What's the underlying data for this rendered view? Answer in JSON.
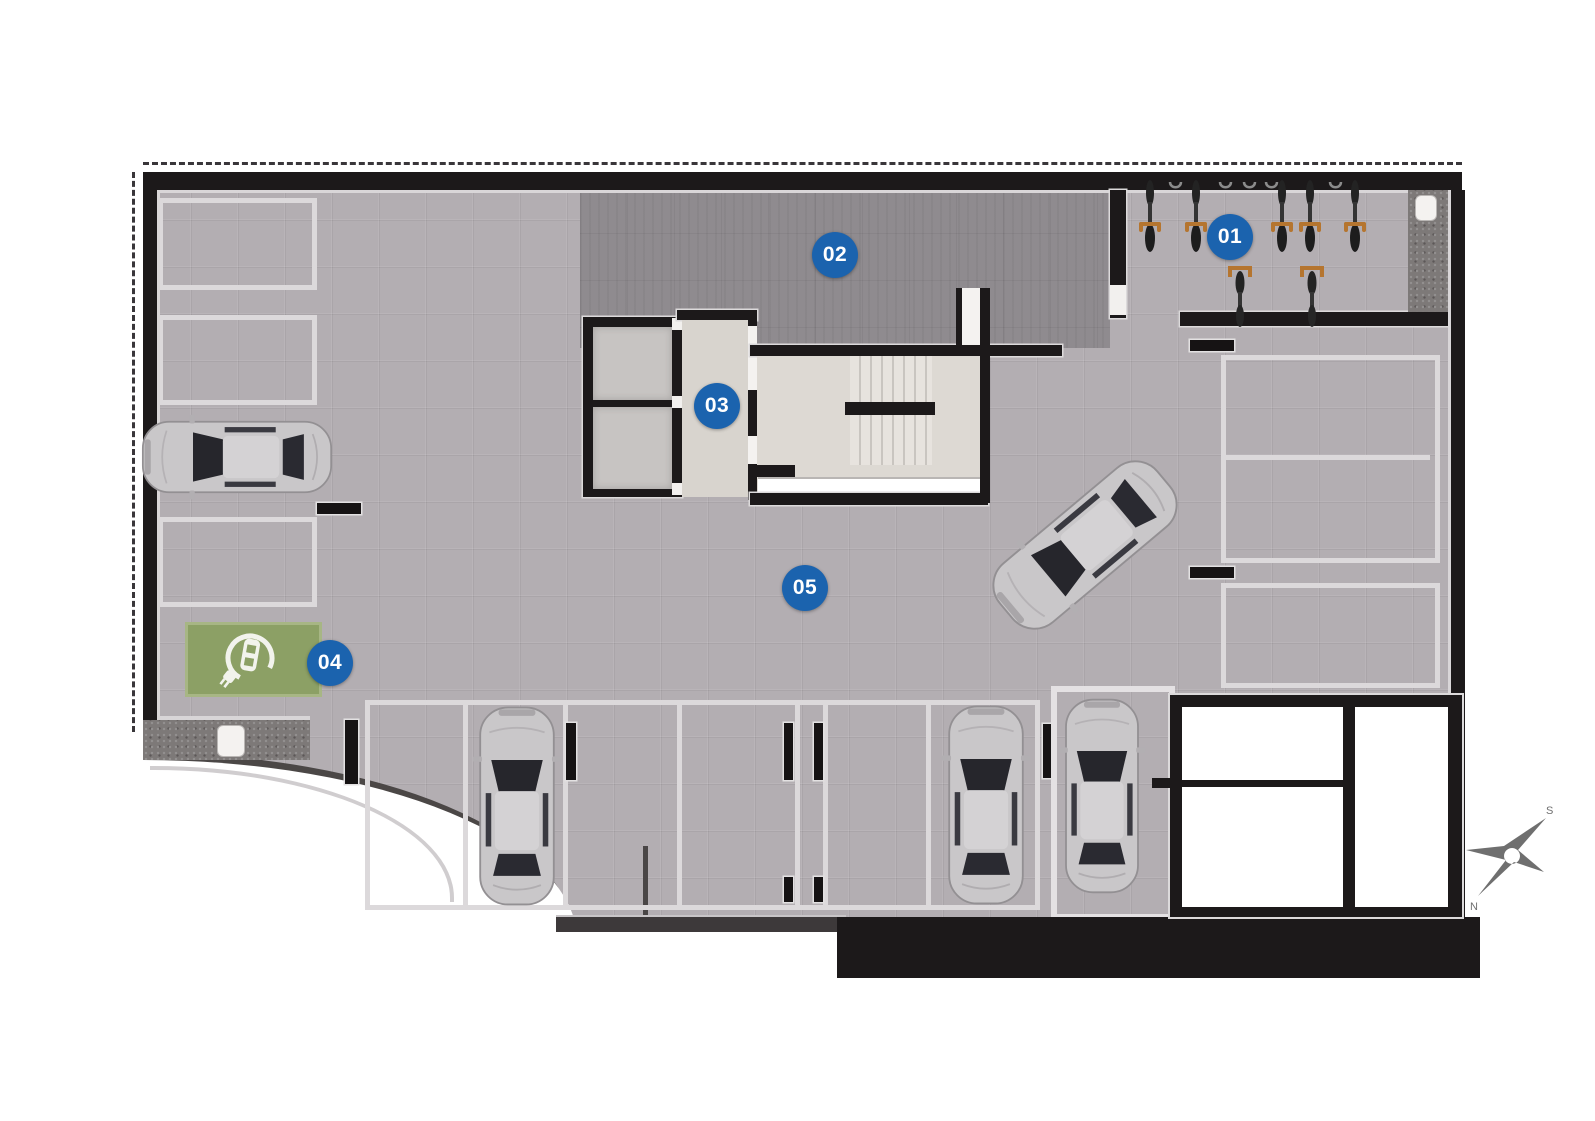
{
  "floorplan": {
    "markers": [
      {
        "label": "01",
        "area": "bike-storage"
      },
      {
        "label": "02",
        "area": "technical-dark-zone"
      },
      {
        "label": "03",
        "area": "elevator-lobby"
      },
      {
        "label": "04",
        "area": "ev-charging-spot"
      },
      {
        "label": "05",
        "area": "parking-floor"
      }
    ],
    "compass": {
      "south": "S",
      "north": "N"
    },
    "colors": {
      "marker_blue": "#1b63ae",
      "ev_pad_green": "#8ca065",
      "wall_black": "#1c191a",
      "floor_gray": "#b3aeb2",
      "dark_floor_gray": "#8f8b8f",
      "compass_gray": "#6f6f6f"
    },
    "icons": {
      "ev_charging": "circular-arrow with car and plug",
      "compass": "four-point star rose",
      "bike": "top-view bicycle",
      "car": "top-view car"
    }
  }
}
